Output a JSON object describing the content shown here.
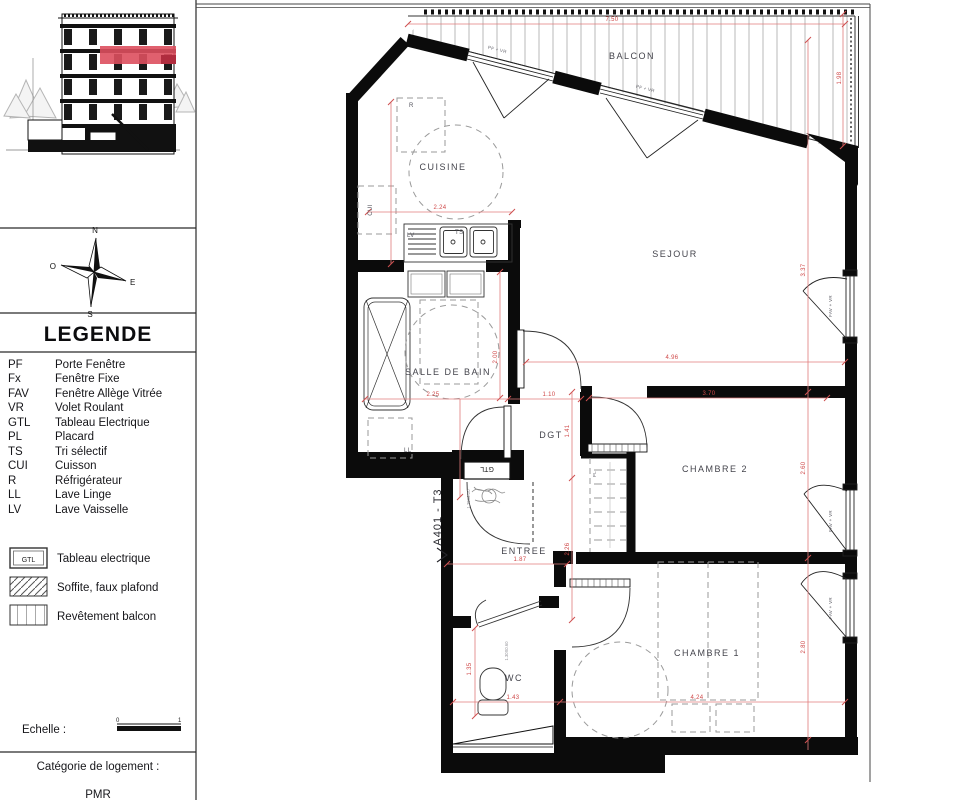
{
  "sidebar": {
    "compass": {
      "n": "N",
      "e": "E",
      "s": "S",
      "o": "O"
    },
    "legend_title": "LEGENDE",
    "abbreviations": [
      {
        "abbr": "PF",
        "label": "Porte Fenêtre"
      },
      {
        "abbr": "Fx",
        "label": "Fenêtre Fixe"
      },
      {
        "abbr": "FAV",
        "label": "Fenêtre Allège Vitrée"
      },
      {
        "abbr": "VR",
        "label": "Volet Roulant"
      },
      {
        "abbr": "GTL",
        "label": "Tableau Electrique"
      },
      {
        "abbr": "PL",
        "label": "Placard"
      },
      {
        "abbr": "TS",
        "label": "Tri sélectif"
      },
      {
        "abbr": "CUI",
        "label": "Cuisson"
      },
      {
        "abbr": "R",
        "label": "Réfrigérateur"
      },
      {
        "abbr": "LL",
        "label": "Lave Linge"
      },
      {
        "abbr": "LV",
        "label": "Lave Vaisselle"
      }
    ],
    "symbols": [
      {
        "box_text": "GTL",
        "label": "Tableau electrique"
      },
      {
        "box_text": "",
        "label": "Soffite, faux plafond"
      },
      {
        "box_text": "",
        "label": "Revêtement balcon"
      }
    ],
    "scale": {
      "label": "Echelle :",
      "tick_start": "0",
      "tick_end": "1"
    },
    "category": {
      "label": "Catégorie de logement :",
      "value": "PMR"
    }
  },
  "plan": {
    "unit_label": "A401 - T3",
    "rooms": {
      "balcon": "BALCON",
      "cuisine": "CUISINE",
      "sejour": "SEJOUR",
      "salle_de_bain": "SALLE DE BAIN",
      "dgt": "DGT",
      "chambre2": "CHAMBRE 2",
      "entree": "ENTREE",
      "wc": "WC",
      "chambre1": "CHAMBRE 1"
    },
    "fixtures": {
      "refrigerateur": "R",
      "cuisson": "CUI",
      "lave_vaisselle": "LV",
      "tri_selectif": "TS",
      "lave_linge": "LL",
      "placard": "PL",
      "tableau": "GTL"
    },
    "window_labels": {
      "pf_vr": "PF + VR",
      "fav_vr": "FAV + VR"
    },
    "dimensions": {
      "balcony_width": "7.50",
      "balcony_depth": "1.98",
      "cuisine_width": "2.24",
      "bain_width": "2.25",
      "dgt_width": "1.10",
      "bain_depth": "2.00",
      "sejour_width": "4.96",
      "sejour_depth": "3.37",
      "chambre2_width": "3.70",
      "chambre2_depth": "2.60",
      "placard_side": "1.41",
      "entree_depth": "2.26",
      "entree_width": "1.87",
      "wc_width": "1.43",
      "wc_depth": "1.35",
      "chambre1_width": "4.24",
      "chambre1_depth": "2.80"
    },
    "annotations": {
      "entry_door": "1.20X2.20",
      "wc_door": "1.30X0.60"
    },
    "accent_colors": {
      "highlight_red": "#dd4f5e",
      "dimension_red": "#cf4848"
    }
  }
}
